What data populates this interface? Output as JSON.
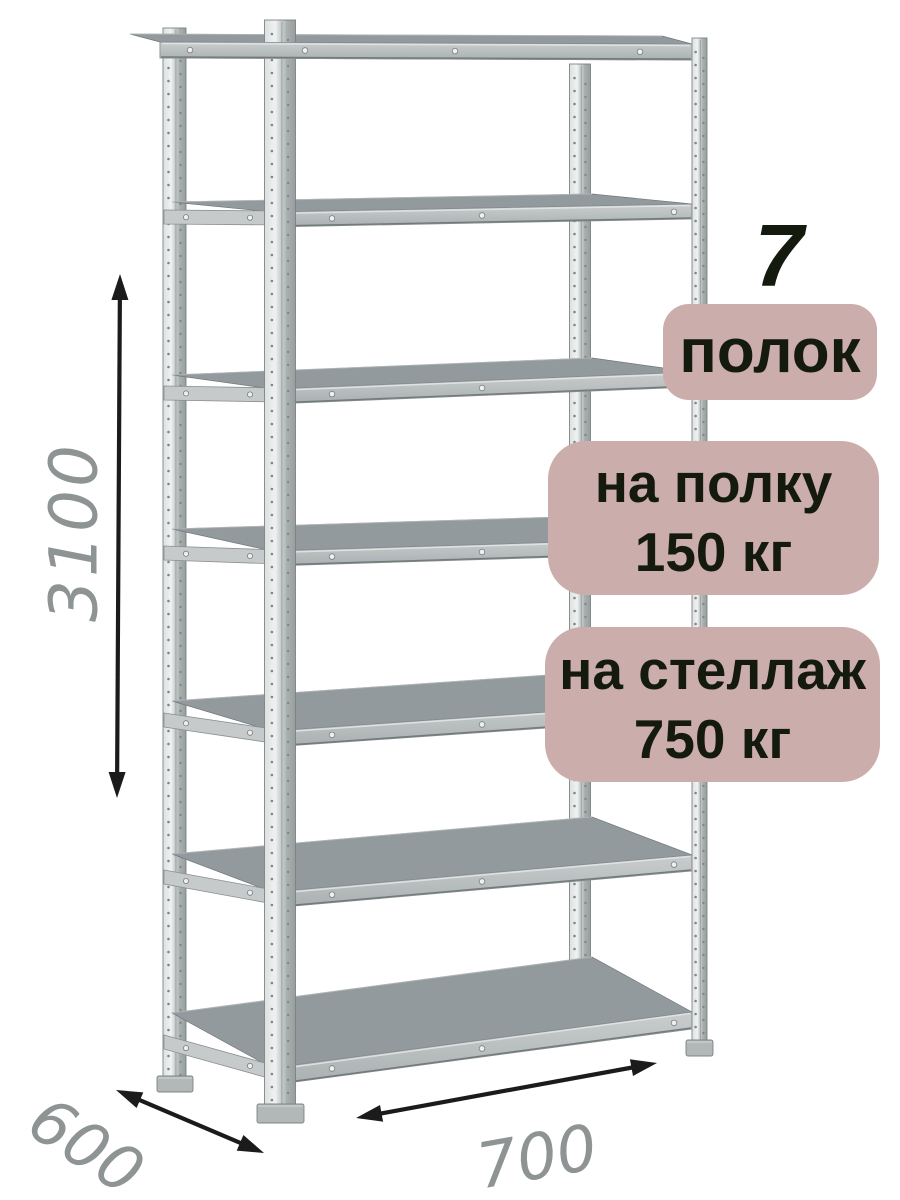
{
  "badges": {
    "shelf_count_number": "7",
    "shelf_count_label": "полок",
    "per_shelf_line1": "на полку",
    "per_shelf_line2": "150 кг",
    "per_rack_line1": "на стеллаж",
    "per_rack_line2": "750 кг",
    "background": "#cbadac",
    "text_color": "#141a0e"
  },
  "dimensions": {
    "height_mm": "3100",
    "depth_mm": "600",
    "width_mm": "700",
    "label_color": "#8e9394",
    "arrow_color": "#1b1b1b"
  },
  "product": {
    "shelf_count": 7,
    "load_per_shelf_kg": 150,
    "load_per_rack_kg": 750,
    "height_mm": 3100,
    "depth_mm": 600,
    "width_mm": 700
  }
}
